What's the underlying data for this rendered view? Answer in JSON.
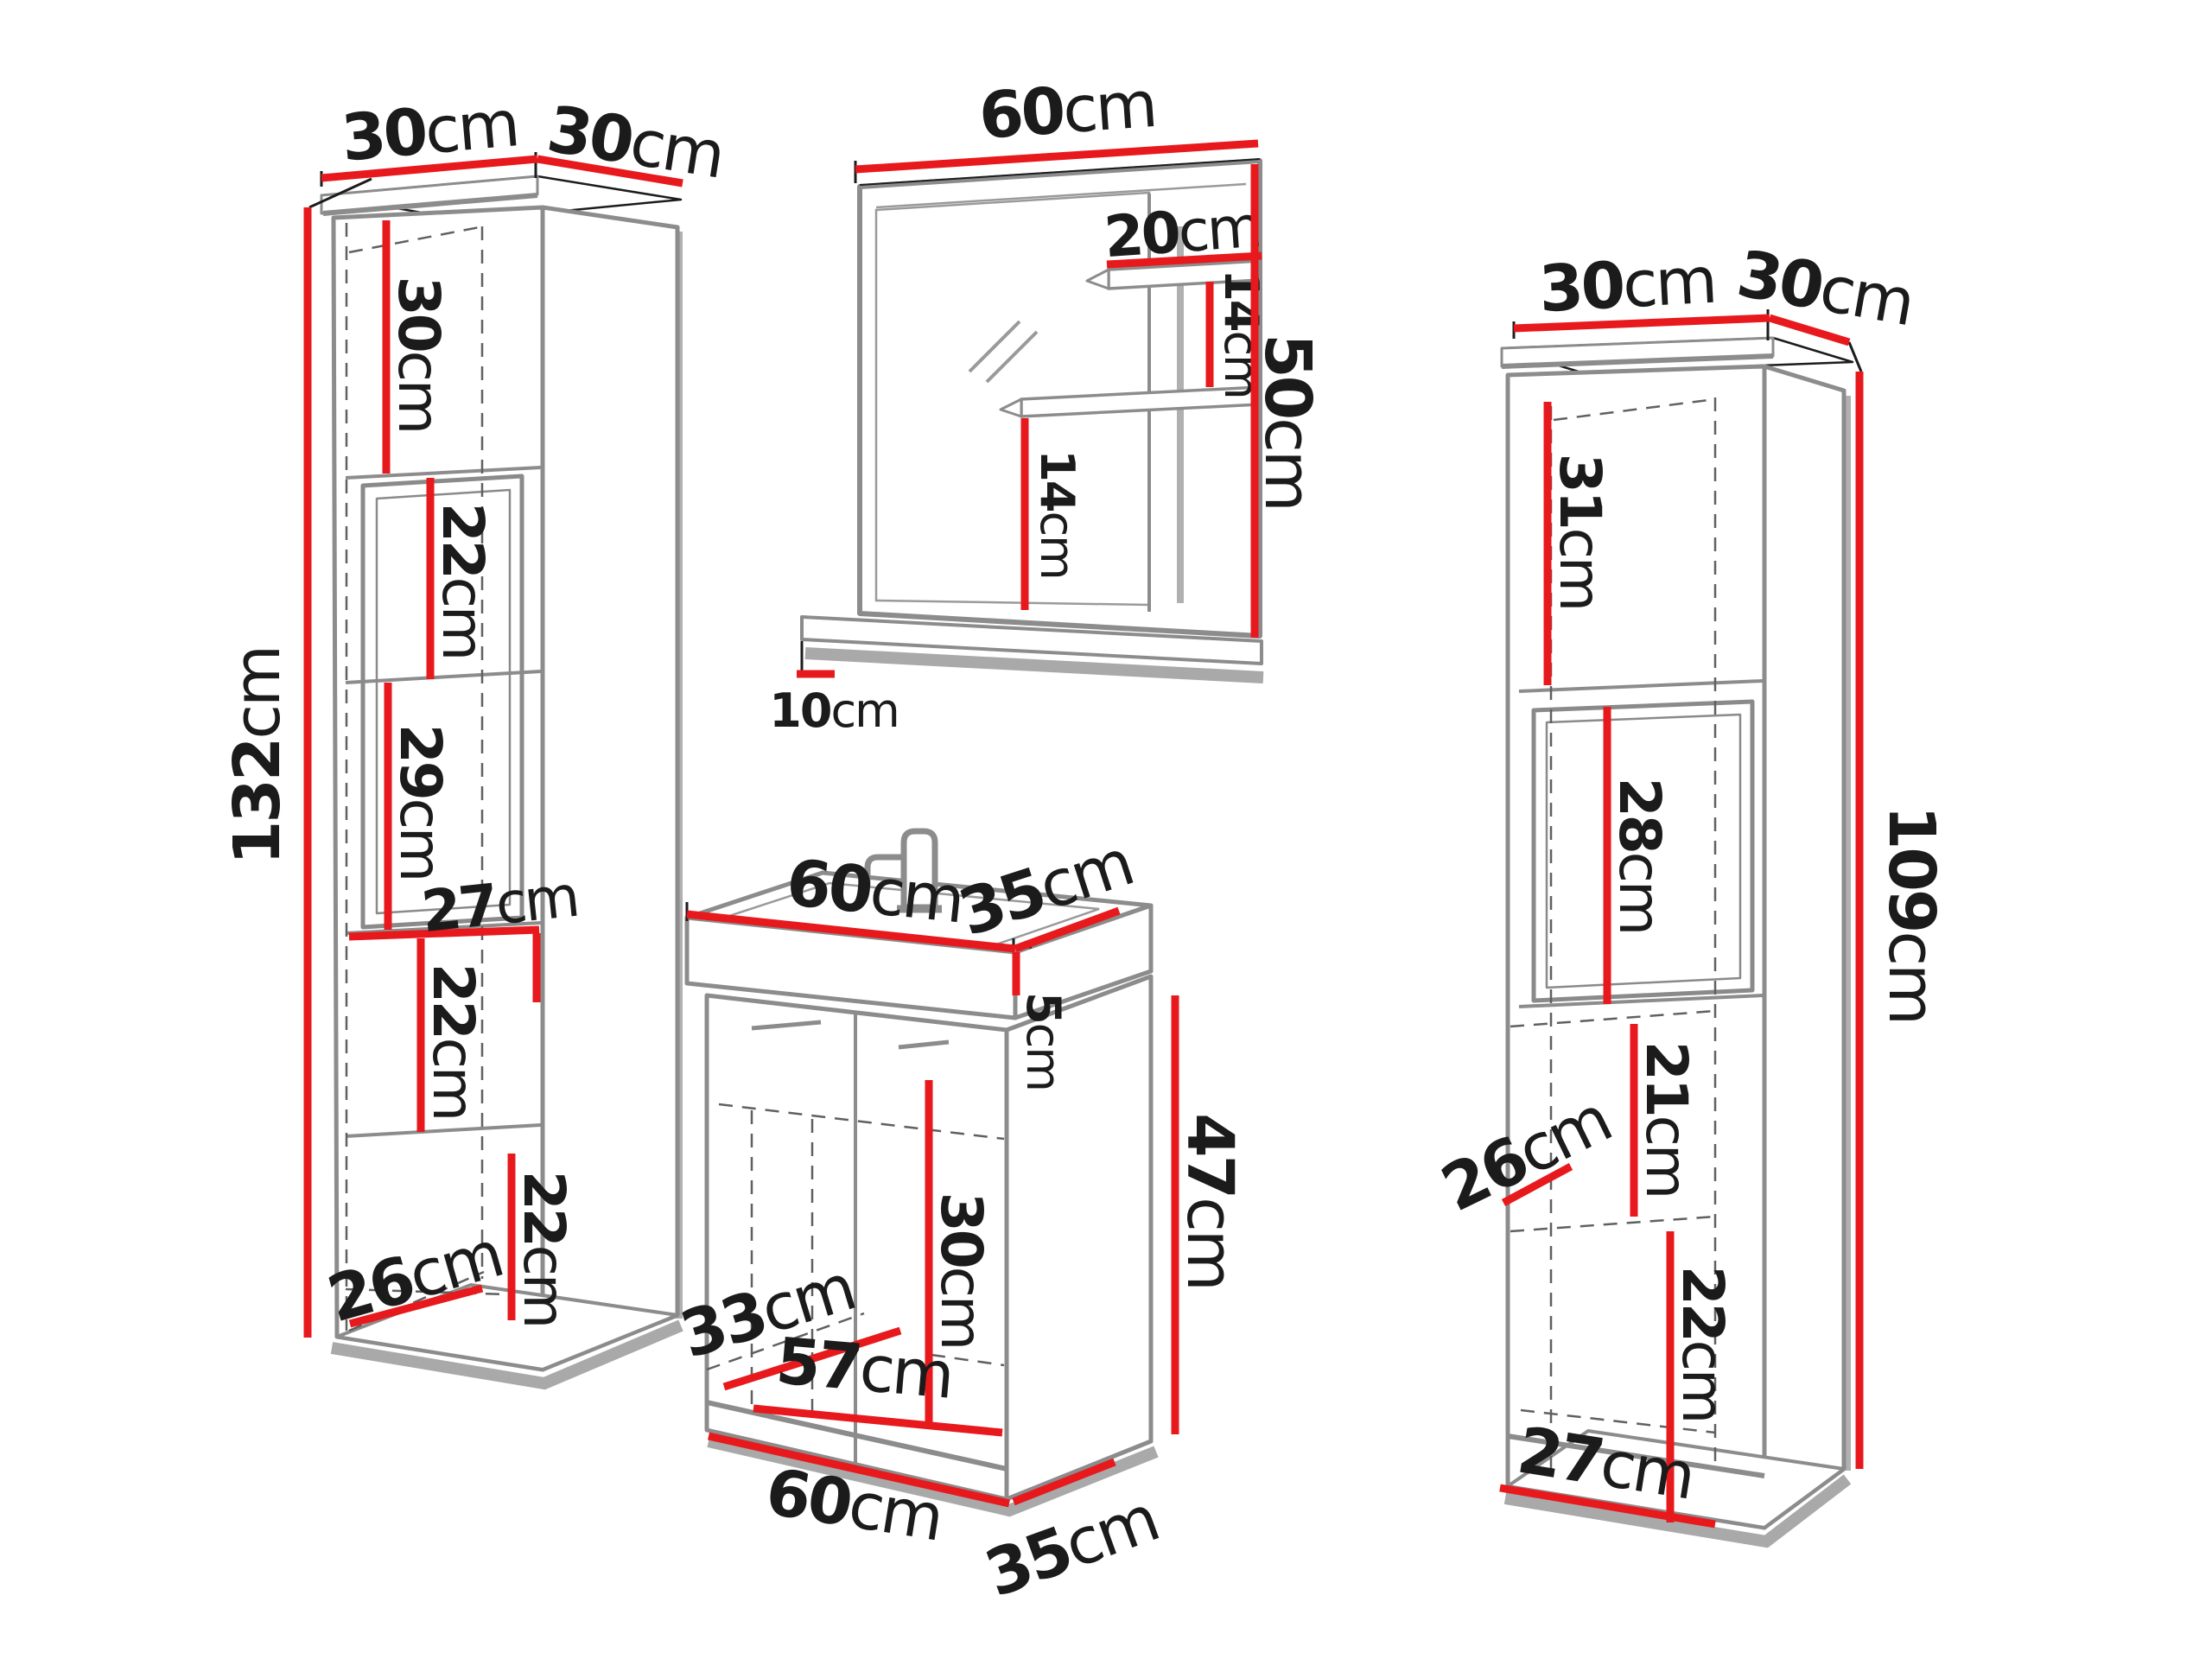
{
  "colors": {
    "dimension_red": "#e8191c",
    "outline_gray": "#8c8c8c",
    "shadow_gray": "#a9a9a9",
    "dash_gray": "#606060",
    "accent_black": "#1c1c1c",
    "text_black": "#1b1b1b"
  },
  "left_cabinet": {
    "top_width": {
      "num": "30",
      "unit": "cm"
    },
    "top_depth": {
      "num": "30",
      "unit": "cm"
    },
    "height": {
      "num": "132",
      "unit": "cm"
    },
    "niche_height": {
      "num": "30",
      "unit": "cm"
    },
    "section1": {
      "num": "22",
      "unit": "cm"
    },
    "section2": {
      "num": "29",
      "unit": "cm"
    },
    "inner_width": {
      "num": "27",
      "unit": "cm"
    },
    "section3": {
      "num": "22",
      "unit": "cm"
    },
    "section4": {
      "num": "22",
      "unit": "cm"
    },
    "inner_depth": {
      "num": "26",
      "unit": "cm"
    }
  },
  "mirror": {
    "width": {
      "num": "60",
      "unit": "cm"
    },
    "shelf_width": {
      "num": "20",
      "unit": "cm"
    },
    "shelf_gap_top": {
      "num": "14",
      "unit": "cm"
    },
    "shelf_gap_bottom": {
      "num": "14",
      "unit": "cm"
    },
    "height": {
      "num": "50",
      "unit": "cm"
    },
    "ledge_depth": {
      "num": "10",
      "unit": "cm"
    }
  },
  "vanity": {
    "top_width": {
      "num": "60",
      "unit": "cm"
    },
    "top_depth": {
      "num": "35",
      "unit": "cm"
    },
    "basin_height": {
      "num": "5",
      "unit": "cm"
    },
    "body_height": {
      "num": "47",
      "unit": "cm"
    },
    "inner_height": {
      "num": "30",
      "unit": "cm"
    },
    "inner_depth": {
      "num": "33",
      "unit": "cm"
    },
    "inner_width": {
      "num": "57",
      "unit": "cm"
    },
    "bottom_width": {
      "num": "60",
      "unit": "cm"
    },
    "bottom_depth": {
      "num": "35",
      "unit": "cm"
    }
  },
  "right_cabinet": {
    "top_width": {
      "num": "30",
      "unit": "cm"
    },
    "top_depth": {
      "num": "30",
      "unit": "cm"
    },
    "height": {
      "num": "109",
      "unit": "cm"
    },
    "niche_height": {
      "num": "31",
      "unit": "cm"
    },
    "door_height": {
      "num": "28",
      "unit": "cm"
    },
    "section1": {
      "num": "21",
      "unit": "cm"
    },
    "inner_depth": {
      "num": "26",
      "unit": "cm"
    },
    "section2": {
      "num": "22",
      "unit": "cm"
    },
    "inner_width": {
      "num": "27",
      "unit": "cm"
    }
  }
}
